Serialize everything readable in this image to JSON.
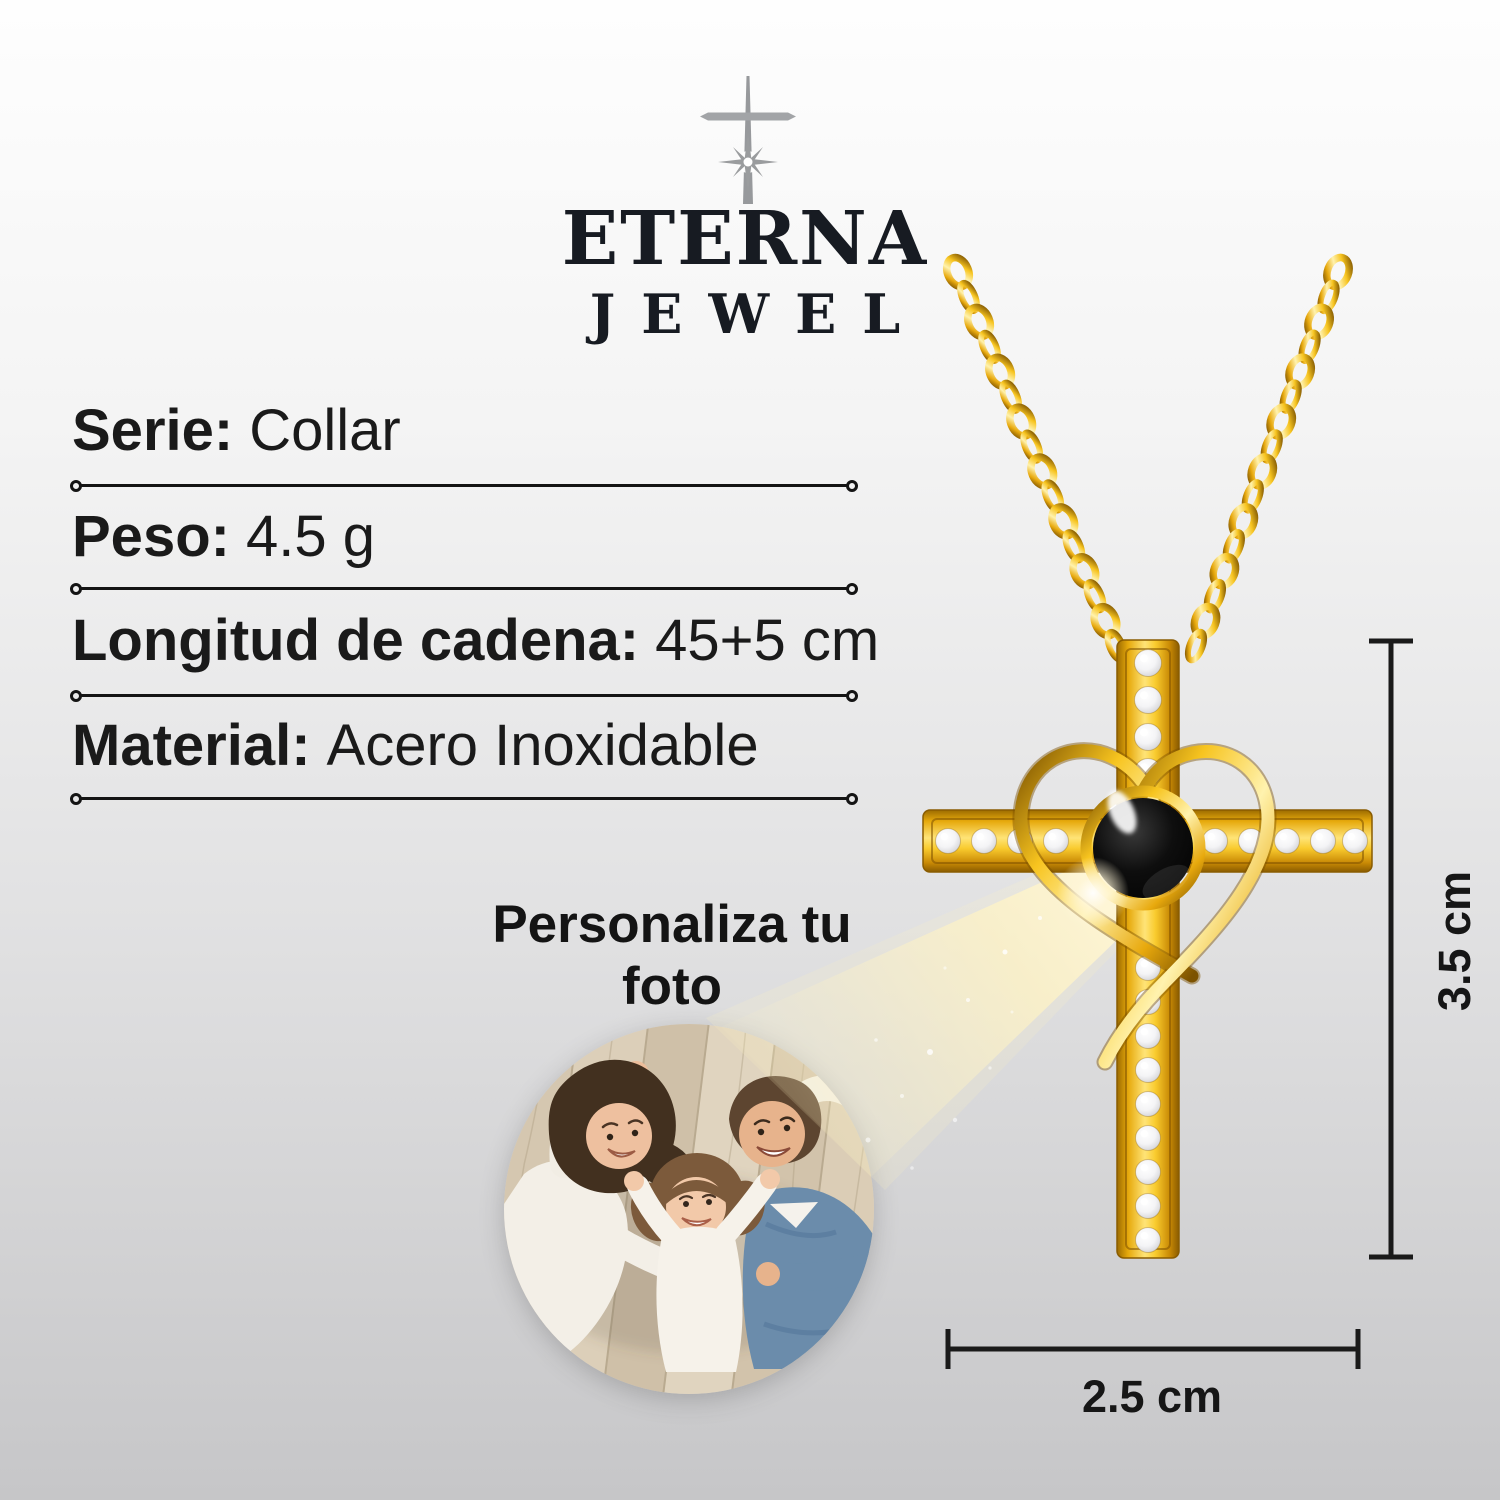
{
  "brand": {
    "wordmark_line1": "ETERNA",
    "wordmark_line2": "JEWEL",
    "icon": "cross-sparkle-icon"
  },
  "specs": [
    {
      "label": "Serie:",
      "value": "Collar"
    },
    {
      "label": "Peso:",
      "value": "4.5 g"
    },
    {
      "label": "Longitud de cadena:",
      "value": "45+5 cm"
    },
    {
      "label": "Material:",
      "value": "Acero Inoxidable"
    }
  ],
  "customize_headline": {
    "line1": "Personaliza tu",
    "line2": "foto"
  },
  "dimensions": {
    "pendant_height": "3.5 cm",
    "pendant_width": "2.5 cm"
  },
  "photo": {
    "subject": "family-photo"
  },
  "product": {
    "type": "gold-cross-heart-projection-pendant"
  },
  "colors": {
    "gold": "#f3c021",
    "gold_dark": "#8a5c00",
    "background_top": "#fefefe",
    "background_bottom": "#c6c6c8",
    "text": "#1a1a1a",
    "logo": "#171b22",
    "stone_black": "#050505",
    "beam_yellow": "#fff3c4",
    "crystal_white": "#f2f2f4"
  }
}
